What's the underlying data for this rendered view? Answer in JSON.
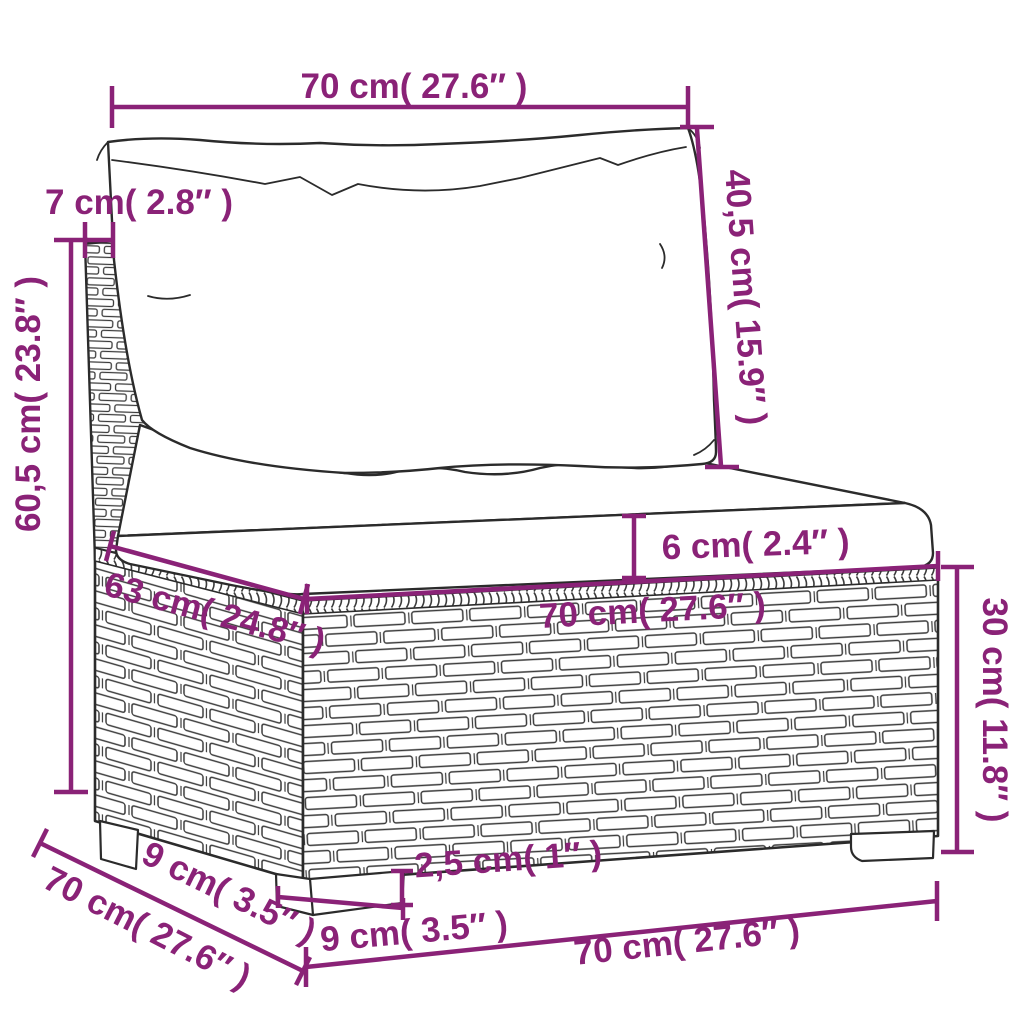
{
  "diagram": {
    "type": "product-dimension-diagram",
    "subject": "rattan-garden-sofa-middle-section-with-cushions",
    "background_color": "#ffffff",
    "accent_color": "#8a2277",
    "outline_color": "#2b2b2b",
    "labels": {
      "top_width": "70 cm( 27.6″ )",
      "post_depth": "7 cm( 2.8″ )",
      "backrest_height": "40,5 cm( 15.9″ )",
      "overall_height": "60,5 cm( 23.8″ )",
      "cushion_thickness": "6 cm( 2.4″ )",
      "seat_front_width": "70 cm( 27.6″ )",
      "base_height": "30 cm( 11.8″ )",
      "seat_depth": "63 cm( 24.8″ )",
      "leg_height": "2,5 cm( 1″ )",
      "leg_front_width": "9 cm( 3.5″ )",
      "leg_side_depth": "9 cm( 3.5″ )",
      "base_side_depth": "70 cm( 27.6″ )",
      "base_front_width": "70 cm( 27.6″ )"
    }
  }
}
